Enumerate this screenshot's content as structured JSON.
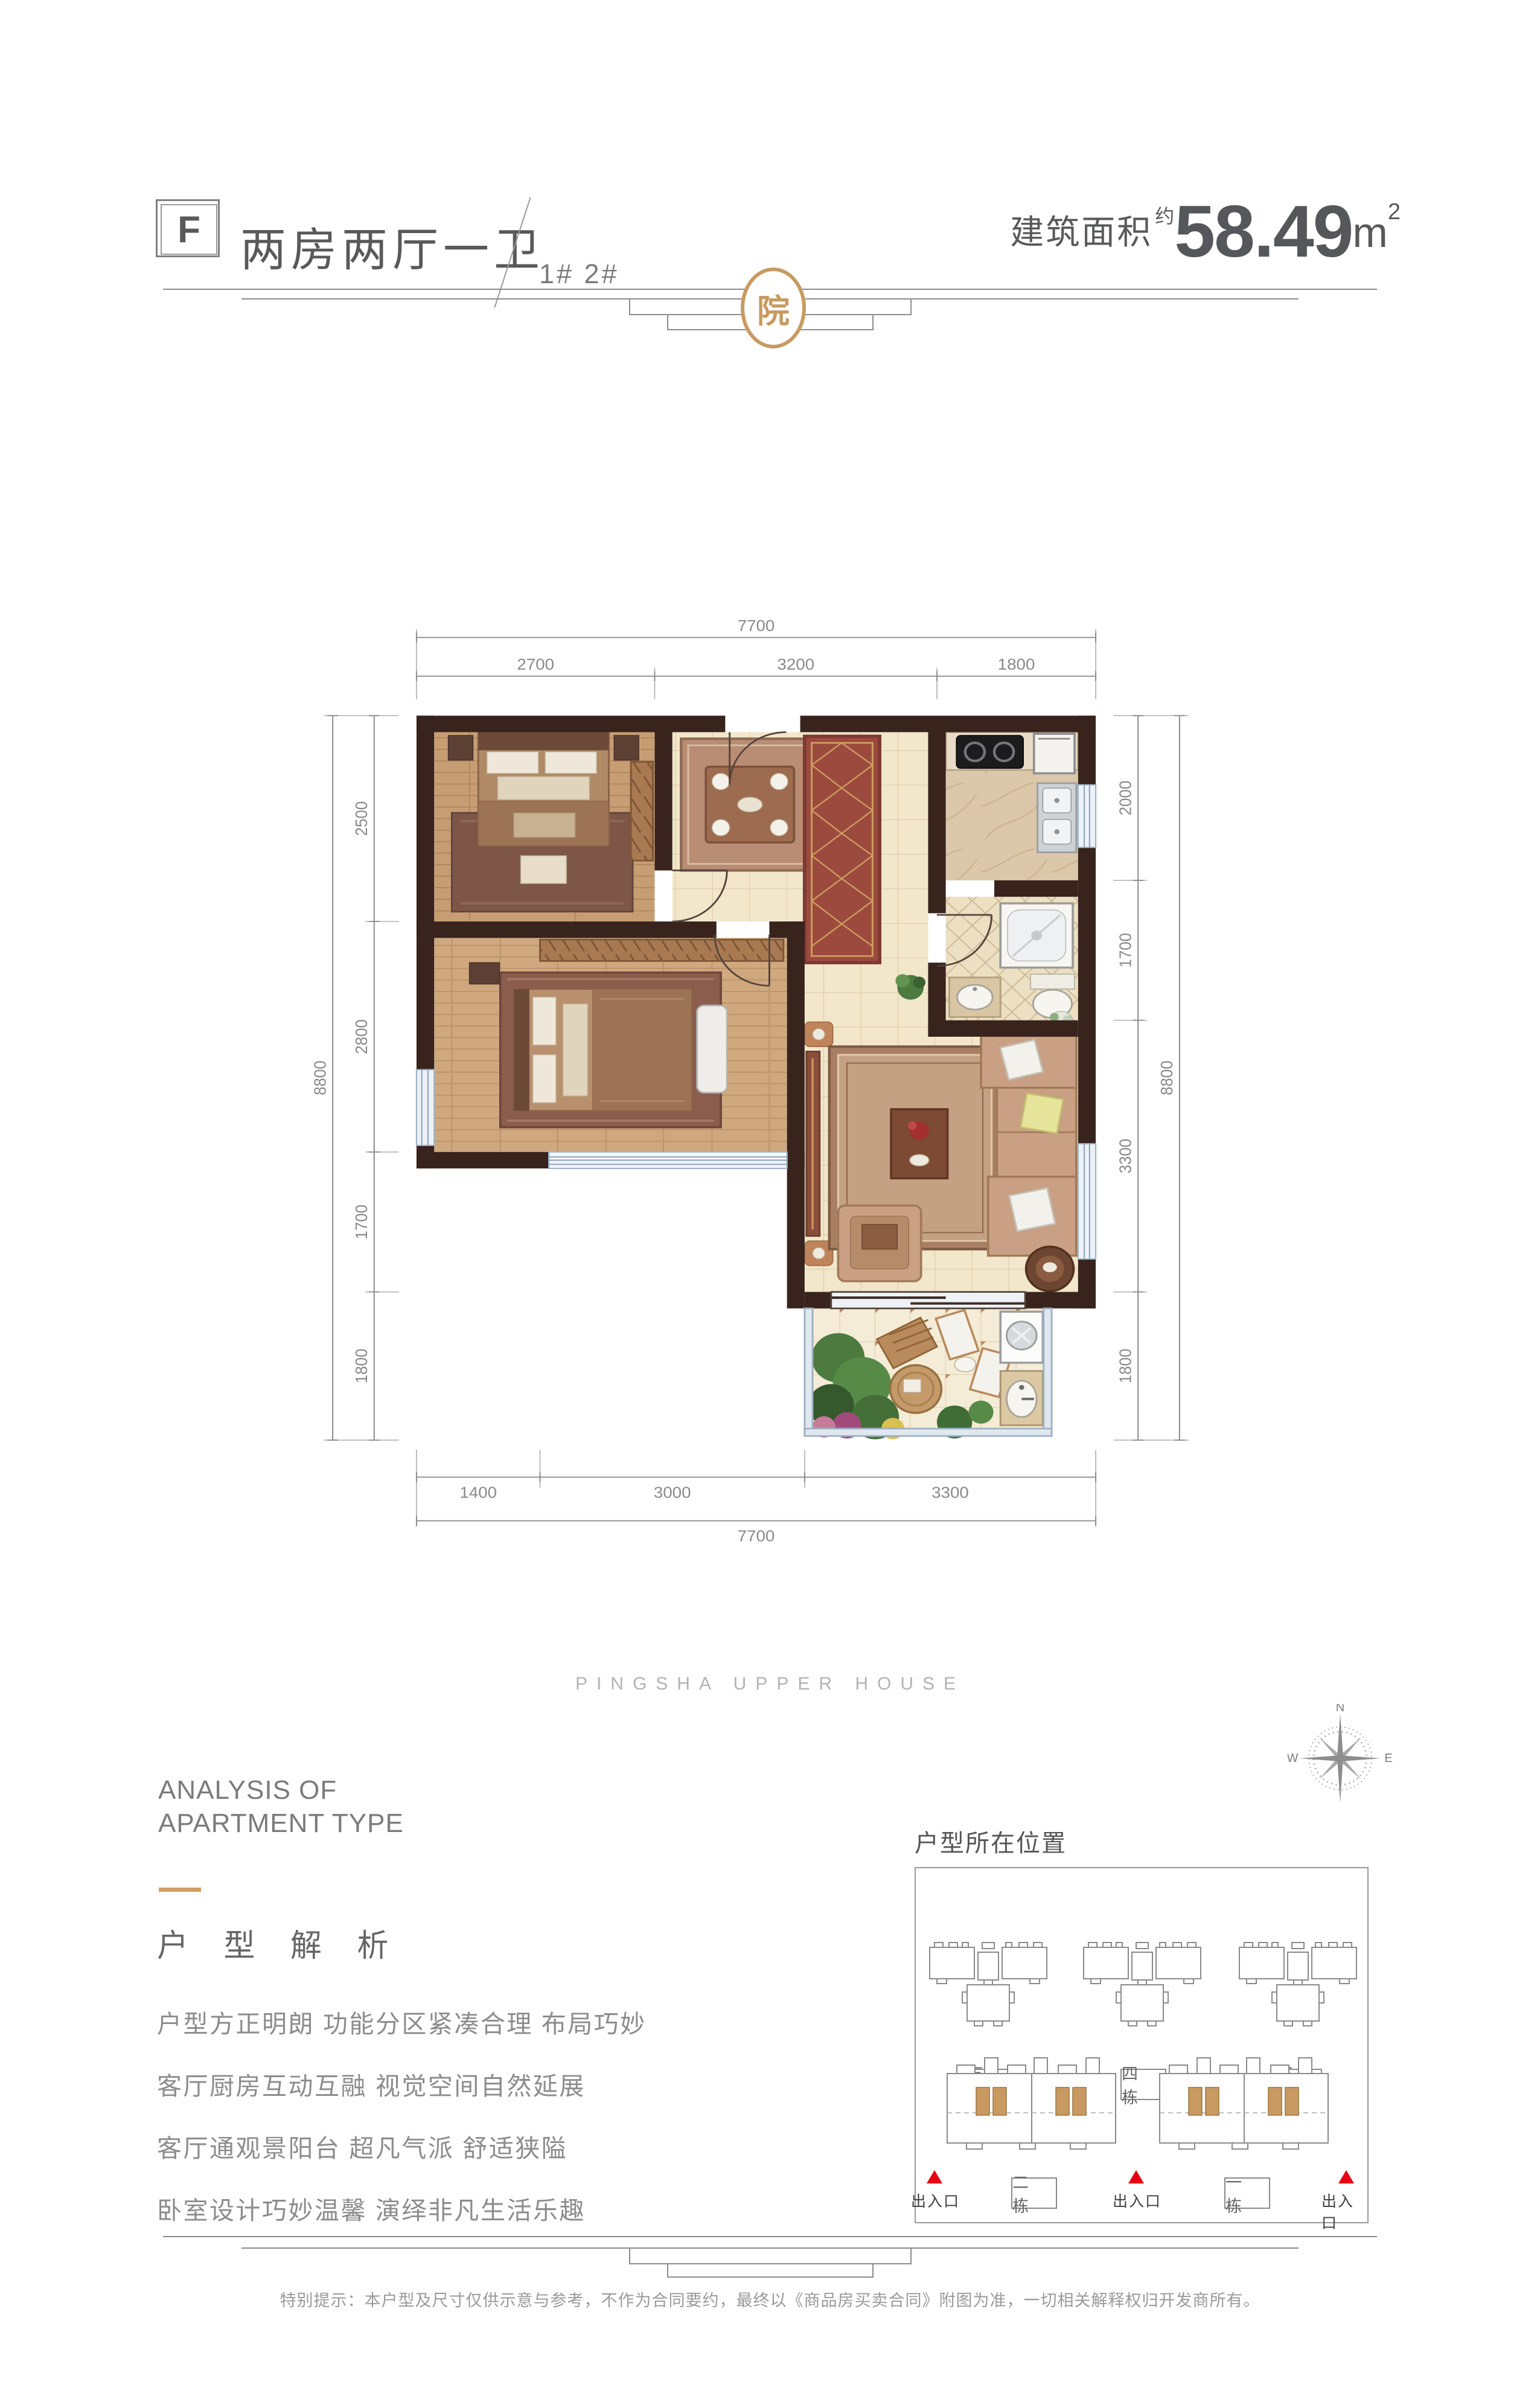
{
  "header": {
    "unit_code": "F",
    "title": "两房两厅一卫",
    "buildings": "1# 2#",
    "area_label": "建筑面积",
    "area_approx": "约",
    "area_value": "58.49",
    "area_unit": "m",
    "area_sup": "2"
  },
  "logo": {
    "char": "院"
  },
  "plan": {
    "dims": {
      "top_total": "7700",
      "top": [
        "2700",
        "3200",
        "1800"
      ],
      "left_total": "8800",
      "left": [
        "2500",
        "2800",
        "1700",
        "1800"
      ],
      "right_total": "8800",
      "right": [
        "2000",
        "1700",
        "3300",
        "1800"
      ],
      "bottom": [
        "1400",
        "3000",
        "3300"
      ],
      "bottom_total": "7700"
    }
  },
  "brand": {
    "en": "PINGSHA UPPER HOUSE"
  },
  "analysis": {
    "en1": "ANALYSIS OF",
    "en2": "APARTMENT TYPE",
    "cn": "户 型 解 析",
    "lines": [
      "户型方正明朗 功能分区紧凑合理 布局巧妙",
      "客厅厨房互动互融 视觉空间自然延展",
      "客厅通观景阳台 超凡气派 舒适狭隘",
      "卧室设计巧妙温馨 演绎非凡生活乐趣"
    ]
  },
  "location": {
    "title": "户型所在位置",
    "top_buildings": [
      "五 栋",
      "四 栋",
      "三 栋"
    ],
    "bottom_buildings": [
      "二 栋",
      "一 栋"
    ],
    "entrance": "出入口"
  },
  "compass": {
    "n": "N",
    "w": "W",
    "e": "E"
  },
  "footer": {
    "disclaimer": "特别提示：本户型及尺寸仅供示意与参考，不作为合同要约，最终以《商品房买卖合同》附图为准，一切相关解释权归开发商所有。"
  },
  "colors": {
    "gold": "#c89a62",
    "wall": "#38231d",
    "entrance_red": "#e60012"
  }
}
